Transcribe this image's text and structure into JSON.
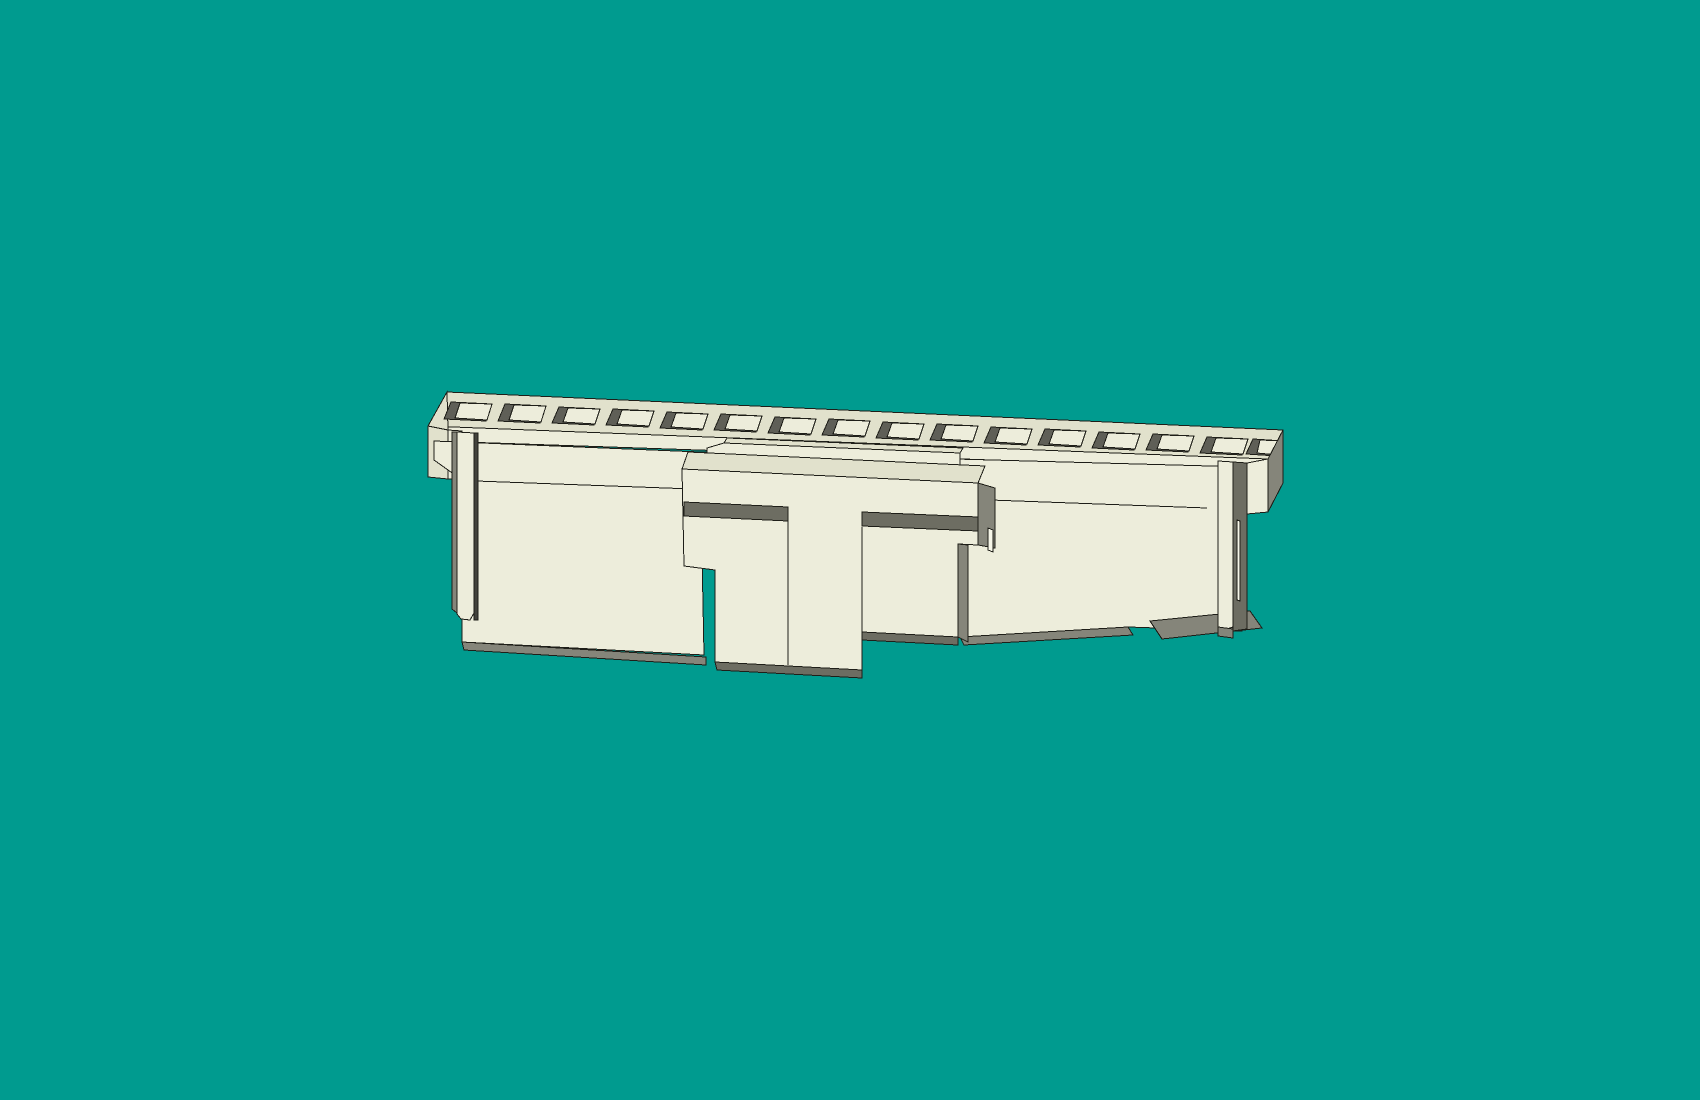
{
  "viewport": {
    "width": 1700,
    "height": 1100,
    "background_color": "#009B8F",
    "model_name": "connector-housing"
  },
  "palette": {
    "background": "#009B8F",
    "front": "#EDEDDB",
    "top": "#E1E1CC",
    "light": "#F6F6E8",
    "gray": "#85857A",
    "grayDark": "#6D6D62",
    "cavity": "#5F5F57",
    "gapDark": "#42423C",
    "line": "#1E1E18"
  },
  "model": {
    "shapes": [
      {
        "name": "rail-top-surface",
        "fill": "top",
        "points": "447,392 1283,430 1268,459 428,426"
      },
      {
        "name": "rail-front-strip",
        "fill": "front",
        "points": "428,426 1268,459 1256,469 434,441"
      },
      {
        "name": "left-end-corner",
        "fill": "top",
        "points": "428,426 447,392 448,430"
      },
      {
        "name": "left-end-cap-side",
        "fill": "top",
        "points": "428,426 448,430 448,479 428,477"
      },
      {
        "name": "left-end-cap-front",
        "fill": "front",
        "points": "448,430 462,431 462,480 448,479"
      },
      {
        "name": "slot-row",
        "type": "slots"
      },
      {
        "name": "left-body-panel",
        "fill": "front",
        "points": "434,441 700,452 704,655 462,642 462,480 434,460"
      },
      {
        "name": "right-body-panel",
        "fill": "front",
        "points": "700,452 1247,467 1242,631 1128,627 960,637"
      },
      {
        "name": "body-seam-edge",
        "fill": "none",
        "points": "476,481 1207,508"
      },
      {
        "name": "left-body-underside",
        "fill": "gray",
        "points": "462,642 706,657 706,665 464,650"
      },
      {
        "name": "right-body-underside",
        "fill": "gray",
        "points": "960,637 1128,627 1133,635 964,645"
      },
      {
        "name": "right-end-foot",
        "fill": "gray",
        "points": "1150,621 1250,611 1262,628 1162,639"
      },
      {
        "name": "center-back-slab-top",
        "fill": "top",
        "points": "727,438 963,448 960,453 724,443"
      },
      {
        "name": "center-back-slab-front",
        "fill": "front",
        "points": "724,443 960,453 960,472 707,462 707,448"
      },
      {
        "name": "center-block-top",
        "fill": "top",
        "points": "688,452 985,466 978,483 682,469"
      },
      {
        "name": "center-block-face",
        "fill": "front",
        "points": "682,469 978,483 978,545 958,544 958,637 862,632 862,670 715,662 715,570 684,566"
      },
      {
        "name": "groove-left",
        "fill": "grayDark",
        "points": "684,502 788,507 788,521 684,516"
      },
      {
        "name": "groove-right",
        "fill": "grayDark",
        "points": "862,512 978,517 978,531 862,526"
      },
      {
        "name": "stem-left-edge",
        "fill": "none",
        "points": "788,508 788,665"
      },
      {
        "name": "stem-right-edge",
        "fill": "none",
        "points": "862,527 862,632"
      },
      {
        "name": "block-right-side",
        "fill": "gray",
        "points": "978,483 995,488 995,548 978,545"
      },
      {
        "name": "block-right-highlight",
        "fill": "light",
        "points": "988,528 993,530 993,552 988,550"
      },
      {
        "name": "right-step-shadow",
        "fill": "gray",
        "points": "958,544 968,545 968,642 958,637"
      },
      {
        "name": "stem-foot-underside",
        "fill": "grayDark",
        "points": "715,662 862,670 862,678 717,670"
      },
      {
        "name": "right-wing-underside",
        "fill": "grayDark",
        "points": "862,632 958,637 958,645 862,640"
      },
      {
        "name": "left-latch-side",
        "fill": "gray",
        "points": "452,432 457,432 457,613 452,609"
      },
      {
        "name": "left-latch-bar",
        "fill": "front",
        "points": "457,432 474,433 474,613 470,620 461,619 457,614"
      },
      {
        "name": "left-latch-gap",
        "fill": "gapDark",
        "points": "474,433 478,433 478,620 474,620"
      },
      {
        "name": "right-latch-bar",
        "fill": "front",
        "points": "1218,461 1233,462 1233,627 1218,632"
      },
      {
        "name": "right-latch-gap",
        "fill": "grayDark",
        "points": "1233,462 1247,463 1247,629 1233,631"
      },
      {
        "name": "right-gap-highlight",
        "fill": "light",
        "points": "1237,520 1240,521 1240,601 1237,600"
      },
      {
        "name": "right-end-block-front",
        "fill": "front",
        "points": "1247,463 1268,459 1268,512 1247,514"
      },
      {
        "name": "right-end-block-side",
        "fill": "gray",
        "points": "1268,459 1283,430 1283,483 1268,512"
      },
      {
        "name": "right-latch-underside",
        "fill": "gray",
        "points": "1218,627 1233,629 1233,638 1218,636"
      }
    ],
    "slot_row": {
      "name": "terminal-slot",
      "cavity_fill": "cavity",
      "wall_fill": "front",
      "items": [
        [
          451,
          402,
          421,
          41
        ],
        [
          505,
          404,
          423,
          41
        ],
        [
          559,
          407,
          425,
          41
        ],
        [
          613,
          409,
          427,
          41
        ],
        [
          667,
          412,
          430,
          41
        ],
        [
          721,
          414,
          432,
          41
        ],
        [
          775,
          417,
          435,
          41
        ],
        [
          829,
          419,
          437,
          41
        ],
        [
          883,
          422,
          440,
          41
        ],
        [
          937,
          424,
          442,
          41
        ],
        [
          991,
          427,
          445,
          41
        ],
        [
          1045,
          429,
          447,
          41
        ],
        [
          1099,
          432,
          450,
          41
        ],
        [
          1153,
          434,
          452,
          41
        ],
        [
          1207,
          437,
          455,
          41
        ],
        [
          1253,
          439,
          456,
          30
        ]
      ]
    }
  }
}
